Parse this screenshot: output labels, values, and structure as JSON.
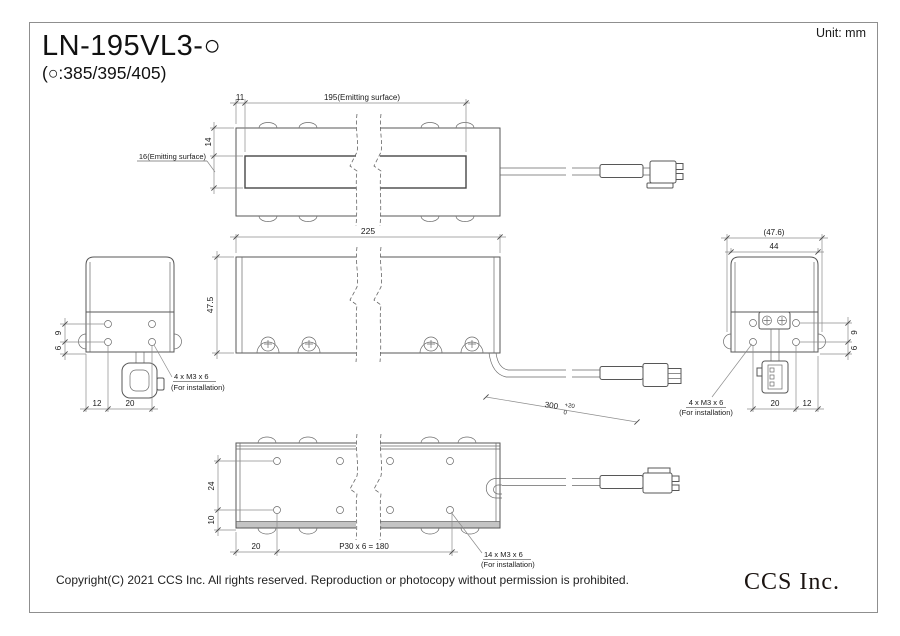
{
  "sheet": {
    "title": "LN-195VL3-○",
    "subtitle": "(○:385/395/405)",
    "unit": "Unit: mm",
    "copyright": "Copyright(C) 2021 CCS Inc. All rights reserved. Reproduction or photocopy without permission is prohibited.",
    "logo": "CCS Inc."
  },
  "top": {
    "dim11": "11",
    "dim195": "195(Emitting surface)",
    "dim14": "14",
    "label16": "16(Emitting surface)"
  },
  "front": {
    "dim225": "225",
    "dim475": "47.5",
    "cable_len": "300",
    "tol_up": "+20",
    "tol_dn": "0"
  },
  "left": {
    "dim9": "9",
    "dim6": "6",
    "dim12": "12",
    "dim20": "20",
    "note1": "4 x M3 x 6",
    "note2": "(For installation)"
  },
  "right": {
    "dim476": "(47.6)",
    "dim44": "44",
    "dim9": "9",
    "dim6": "6",
    "dim20": "20",
    "dim12": "12",
    "note1": "4 x M3 x 6",
    "note2": "(For installation)"
  },
  "bottom": {
    "dim24": "24",
    "dim10": "10",
    "dim20": "20",
    "dimP30": "P30 x 6 = 180",
    "note1": "14 x M3 x 6",
    "note2": "(For installation)"
  }
}
